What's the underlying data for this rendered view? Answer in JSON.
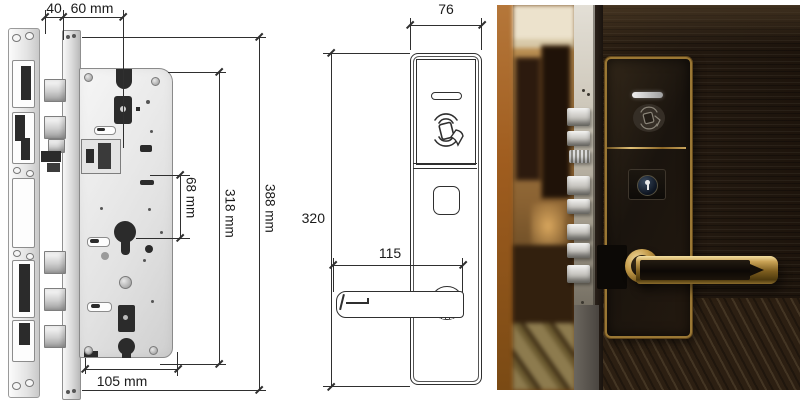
{
  "lock_body_drawing": {
    "dim_backset": "40",
    "dim_case_width": "60 mm",
    "dim_center_distance": "68 mm",
    "dim_case_height": "318 mm",
    "dim_faceplate_height": "388 mm",
    "dim_case_depth": "105 mm"
  },
  "panel_drawing": {
    "dim_width": "76",
    "dim_height": "320",
    "dim_handle_length": "115"
  },
  "icons": {
    "card_reader_icon": "rfid-card-tap-arcs",
    "keyhole_icon": "keyhole-in-circle",
    "led_indicator_icon": "status-slit"
  },
  "colors": {
    "drawing_line": "#2f2f2f",
    "gold_trim": "#b8923f",
    "door_wood": "#261b10",
    "wall_orange": "#a86224",
    "steel_light": "#f2f2f2",
    "steel_dark": "#8f8f8f",
    "carpet": "#8d7b4e"
  }
}
